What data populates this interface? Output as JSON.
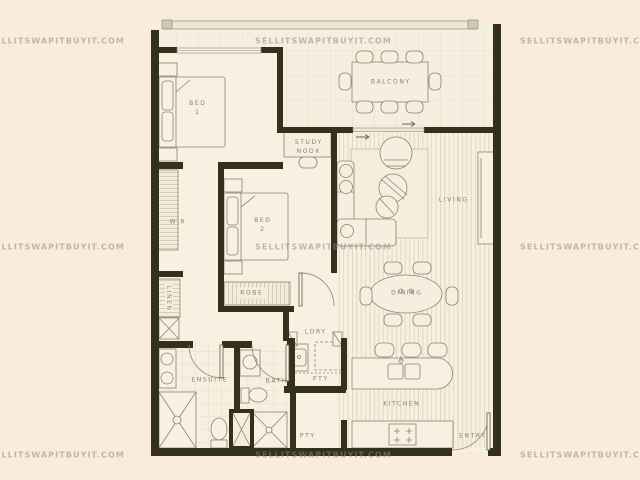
{
  "watermark": {
    "text": "SELLITSWAPITBUYIT.COM",
    "color": "#8f8b82"
  },
  "palette": {
    "background": "#f9ecdb",
    "floor": "#f8f1e2",
    "wall": "#34301e",
    "furniture_line": "#8b8372",
    "label_text": "#8a8070"
  },
  "rooms": {
    "balcony": {
      "label": "BALCONY"
    },
    "bed1": {
      "label": "BED",
      "label2": "1"
    },
    "study_nook": {
      "label": "STUDY",
      "label2": "NOOK"
    },
    "wir": {
      "label": "WIR"
    },
    "bed2": {
      "label": "BED",
      "label2": "2"
    },
    "living": {
      "label": "LIVING"
    },
    "dining": {
      "label": "DINING"
    },
    "linen": {
      "label": "LINEN"
    },
    "robe": {
      "label": "ROBE"
    },
    "ldry": {
      "label": "LDRY"
    },
    "pty_upper": {
      "label": "PTY"
    },
    "ensuite": {
      "label": "ENSUITE"
    },
    "bath": {
      "label": "BATH"
    },
    "pty_lower": {
      "label": "PTY"
    },
    "kitchen": {
      "label": "KITCHEN"
    },
    "entry": {
      "label": "ENTRY"
    }
  }
}
